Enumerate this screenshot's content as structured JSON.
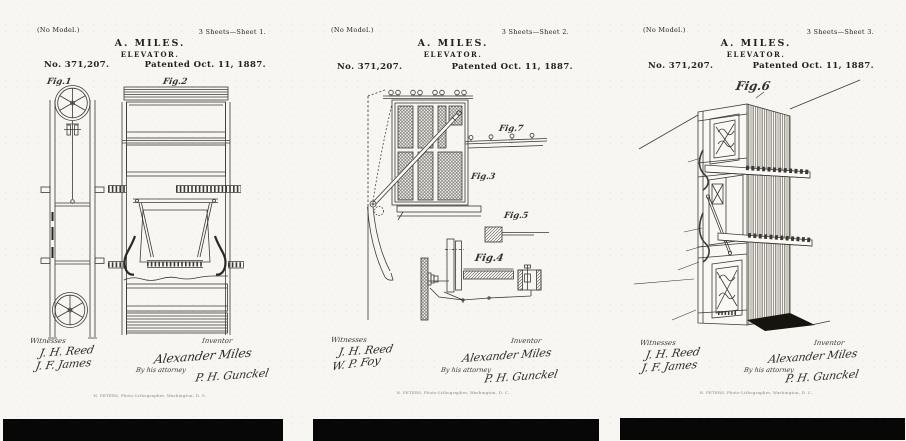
{
  "doc": {
    "no_model": "(No Model.)",
    "heading_name": "A. MILES.",
    "heading_title": "ELEVATOR.",
    "patent_number": "No. 371,207.",
    "patent_date": "Patented Oct. 11, 1887.",
    "witnesses_label": "Witnesses",
    "inventor_label": "Inventor",
    "attorney_label": "By his attorney",
    "printer_line": "N. PETERS, Photo-Lithographer, Washington, D. C.",
    "ink_color": "#22211f",
    "paper_color": "#f7f6f3"
  },
  "sheets": [
    {
      "sheet_label": "3 Sheets—Sheet 1.",
      "figures": [
        "Fig.1",
        "Fig.2"
      ],
      "witnesses": [
        "J. H. Reed",
        "J. F. James"
      ],
      "inventor_signature": "Alexander Miles",
      "attorney_signature": "P. H. Gunckel"
    },
    {
      "sheet_label": "3 Sheets—Sheet 2.",
      "figures": [
        "Fig.7",
        "Fig.3",
        "Fig.5",
        "Fig.4"
      ],
      "witnesses": [
        "J. H. Reed",
        "W. P. Foy"
      ],
      "inventor_signature": "Alexander Miles",
      "attorney_signature": "P. H. Gunckel"
    },
    {
      "sheet_label": "3 Sheets—Sheet 3.",
      "figures": [
        "Fig.6"
      ],
      "witnesses": [
        "J. H. Reed",
        "J. F. James"
      ],
      "inventor_signature": "Alexander Miles",
      "attorney_signature": "P. H. Gunckel"
    }
  ]
}
